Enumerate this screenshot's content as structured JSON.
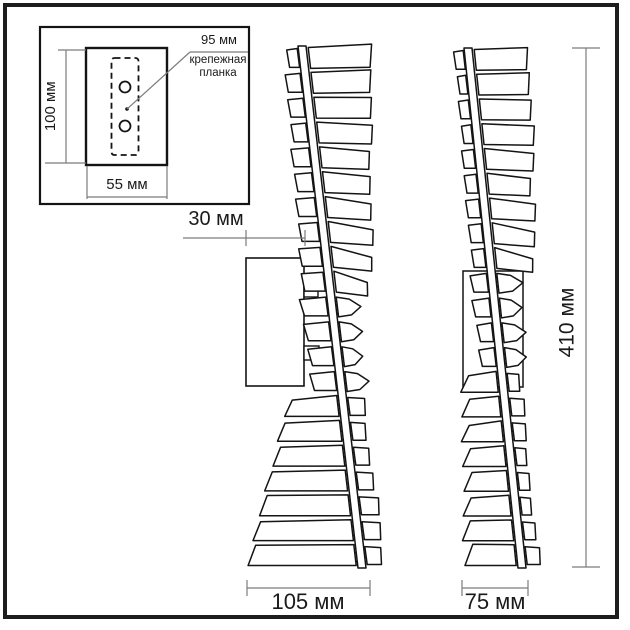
{
  "labels": {
    "inset_height": "100 мм",
    "inset_width": "55 мм",
    "inset_plate_width": "95 мм",
    "inset_plate_name_1": "крепежная",
    "inset_plate_name_2": "планка",
    "bracket_depth": "30 мм",
    "side_width": "105 мм",
    "front_width": "75 мм",
    "total_height": "410 мм"
  },
  "colors": {
    "outline": "#141414",
    "dimension": "#7c7c7c",
    "text": "#1a1a1a",
    "frame": "#1d1d1d",
    "background": "#ffffff"
  }
}
